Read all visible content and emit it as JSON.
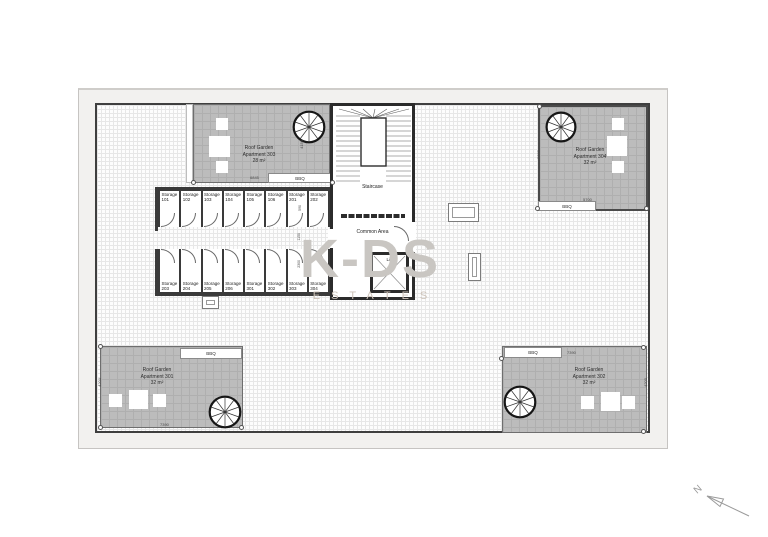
{
  "watermark": {
    "primary": "K-DS",
    "secondary": "ESTATES"
  },
  "core": {
    "staircase": "Staircase",
    "common_area": "Common Area",
    "lift": "Lift"
  },
  "gardens": {
    "g303": {
      "name": "Roof Garden\nApartment 303\n28 m²",
      "bbq": "BBQ",
      "dim_w": "6845",
      "dim_h": "4150"
    },
    "g304": {
      "name": "Roof Garden\nApartment 304\n32 m²",
      "bbq": "BBQ",
      "dim_w": "5700",
      "dim_h": "5300"
    },
    "g301": {
      "name": "Roof Garden\nApartment 301\n32 m²",
      "bbq": "BBQ",
      "dim_w": "7390",
      "dim_h": "4200"
    },
    "g302": {
      "name": "Roof Garden\nApartment 302\n32 m²",
      "bbq": "BBQ",
      "dim_w": "7390",
      "dim_h": "4200"
    }
  },
  "storage": {
    "top": [
      "Storage\n101",
      "Storage\n102",
      "Storage\n103",
      "Storage\n104",
      "Storage\n105",
      "Storage\n106",
      "Storage\n201",
      "Storage\n202"
    ],
    "bottom": [
      "Storage\n203",
      "Storage\n204",
      "Storage\n205",
      "Storage\n206",
      "Storage\n301",
      "Storage\n302",
      "Storage\n303",
      "Storage\n304"
    ]
  },
  "dims": {
    "corridor_a": "590",
    "corridor_b": "1150",
    "corridor_c": "2300"
  },
  "north": {
    "label": "N"
  },
  "colors": {
    "wall": "#2b2b2b",
    "garden_fill": "#bcbcbc",
    "watermark": "#c9c6c2"
  }
}
